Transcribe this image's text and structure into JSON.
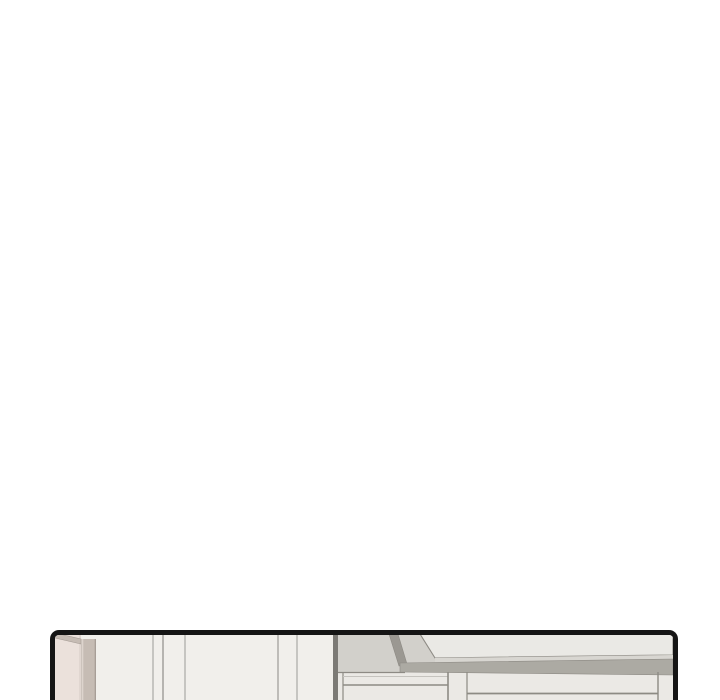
{
  "page": {
    "background": "#ffffff",
    "content_note": ""
  },
  "panel": {
    "border_color": "#151515",
    "colors": {
      "wall": "#f1efeb",
      "wall_seam": "#9c9b97",
      "door": "#ebe1db",
      "door_edge": "#d8cfc8",
      "frame": "#c6bcb4",
      "frame_highlight": "#ddd4cd",
      "frame_shadow": "#a49b94",
      "corner_edge": "#7c7a75",
      "soffit": "#d2d0cb",
      "hood_face": "#eae9e5",
      "hood_edge": "#8d8a84",
      "hood_slant": "#9b9892",
      "band_light": "#d8d6d1",
      "band_dark": "#acaaa3",
      "cabinet": "#ebe9e5",
      "cabinet_line": "#8d8b84",
      "cabinet_soft_line": "#c5c3be"
    }
  }
}
